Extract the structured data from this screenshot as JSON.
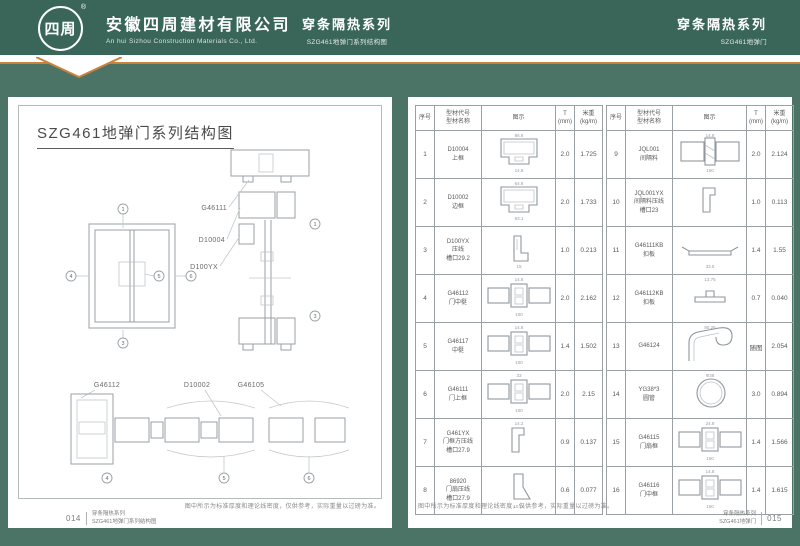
{
  "colors": {
    "header_green": "#3a665a",
    "body_green": "#4b7466",
    "accent_orange": "#c8823e",
    "drawing_gray": "#98a0a4"
  },
  "header": {
    "logo_text": "四周",
    "logo_reg": "®",
    "company_cn": "安徽四周建材有限公司",
    "company_en": "An hui Sizhou Construction Materials Co., Ltd.",
    "center_title": "穿条隔热系列",
    "center_subtitle": "SZG461地弹门系列结构图",
    "right_title": "穿条隔热系列",
    "right_subtitle": "SZG461地弹门"
  },
  "left_page": {
    "title": "SZG461地弹门系列结构图",
    "part_labels": [
      "G46111",
      "D10004",
      "D100YX",
      "G46112",
      "D10002",
      "G46105"
    ],
    "markers": {
      "elevation": [
        "1",
        "3",
        "4",
        "5",
        "6"
      ],
      "vertical": [
        "1",
        "3"
      ],
      "horizontal": [
        "4",
        "5",
        "6"
      ]
    },
    "note": "图中所示为标准厚度和理论线密度，仅供参考，实际重量以过磅为准。",
    "footer": {
      "page_no": "014",
      "series": "穿条隔热系列",
      "doc": "SZG461地弹门系列结构图"
    }
  },
  "right_page": {
    "table_header": {
      "no": "序号",
      "code": "型材代号",
      "name": "型材名称",
      "diagram": "图示",
      "t": "T",
      "t_unit": "(mm)",
      "weight": "米重",
      "weight_unit": "(kg/m)"
    },
    "rows": [
      {
        "no": "1",
        "code": "D10004",
        "name": "上框",
        "name2": "",
        "t": "2.0",
        "w": "1.725",
        "shape": "frame",
        "dim_top": "86.8",
        "dim_bottom": "14.8"
      },
      {
        "no": "2",
        "code": "D10002",
        "name": "边框",
        "name2": "",
        "t": "2.0",
        "w": "1.733",
        "shape": "frame",
        "dim_top": "64.8",
        "dim_bottom": "83.1"
      },
      {
        "no": "3",
        "code": "D100YX",
        "name": "压线",
        "name2": "槽口29.2",
        "t": "1.0",
        "w": "0.213",
        "shape": "bead",
        "dim_top": "",
        "dim_bottom": "15"
      },
      {
        "no": "4",
        "code": "G46112",
        "name": "门中梃",
        "name2": "",
        "t": "2.0",
        "w": "2.162",
        "shape": "mullion",
        "dim_top": "14.8",
        "dim_bottom": "100"
      },
      {
        "no": "5",
        "code": "G46117",
        "name": "中梃",
        "name2": "",
        "t": "1.4",
        "w": "1.502",
        "shape": "mullion",
        "dim_top": "14.8",
        "dim_bottom": "100"
      },
      {
        "no": "6",
        "code": "G46111",
        "name": "门上框",
        "name2": "",
        "t": "2.0",
        "w": "2.15",
        "shape": "mullion",
        "dim_top": "33",
        "dim_bottom": "100"
      },
      {
        "no": "7",
        "code": "G461YX",
        "name": "门框方压线",
        "name2": "槽口27.9",
        "t": "0.9",
        "w": "0.137",
        "shape": "bead-sm",
        "dim_top": "14.2",
        "dim_bottom": ""
      },
      {
        "no": "8",
        "code": "86920",
        "name": "门扇压线",
        "name2": "槽口27.9",
        "t": "0.6",
        "w": "0.077",
        "shape": "bead-angle",
        "dim_top": "",
        "dim_bottom": "10.16"
      },
      {
        "no": "9",
        "code": "JQL001",
        "name": "间隔料",
        "name2": "",
        "t": "2.0",
        "w": "2.124",
        "shape": "spacer",
        "dim_top": "14.8",
        "dim_bottom": "100"
      },
      {
        "no": "10",
        "code": "JQL001YX",
        "name": "间隔料压线",
        "name2": "槽口23",
        "t": "1.0",
        "w": "0.113",
        "shape": "bead-sm",
        "dim_top": "",
        "dim_bottom": ""
      },
      {
        "no": "11",
        "code": "G46111KB",
        "name": "扣板",
        "name2": "",
        "t": "1.4",
        "w": "1.55",
        "shape": "plate",
        "dim_top": "",
        "dim_bottom": "33.5"
      },
      {
        "no": "12",
        "code": "G46112KB",
        "name": "扣板",
        "name2": "",
        "t": "0.7",
        "w": "0.040",
        "shape": "plate-sm",
        "dim_top": "13.75",
        "dim_bottom": ""
      },
      {
        "no": "13",
        "code": "G46124",
        "name": "",
        "name2": "",
        "t": "随图",
        "w": "2.054",
        "shape": "hook",
        "dim_top": "80.28",
        "dim_bottom": ""
      },
      {
        "no": "14",
        "code": "YG38*3",
        "name": "圆管",
        "name2": "",
        "t": "3.0",
        "w": "0.894",
        "shape": "circle",
        "dim_top": "Φ38",
        "dim_bottom": ""
      },
      {
        "no": "15",
        "code": "G46115",
        "name": "门扇框",
        "name2": "",
        "t": "1.4",
        "w": "1.566",
        "shape": "mullion",
        "dim_top": "24.9",
        "dim_bottom": "100"
      },
      {
        "no": "16",
        "code": "G46116",
        "name": "门中框",
        "name2": "",
        "t": "1.4",
        "w": "1.615",
        "shape": "mullion",
        "dim_top": "14.8",
        "dim_bottom": "100"
      }
    ],
    "note": "图中所示为标准厚度和理论线密度，仅供参考，实际重量以过磅为准。",
    "footer": {
      "series": "穿条隔热系列",
      "doc": "SZG461地弹门",
      "page_no": "015"
    }
  }
}
